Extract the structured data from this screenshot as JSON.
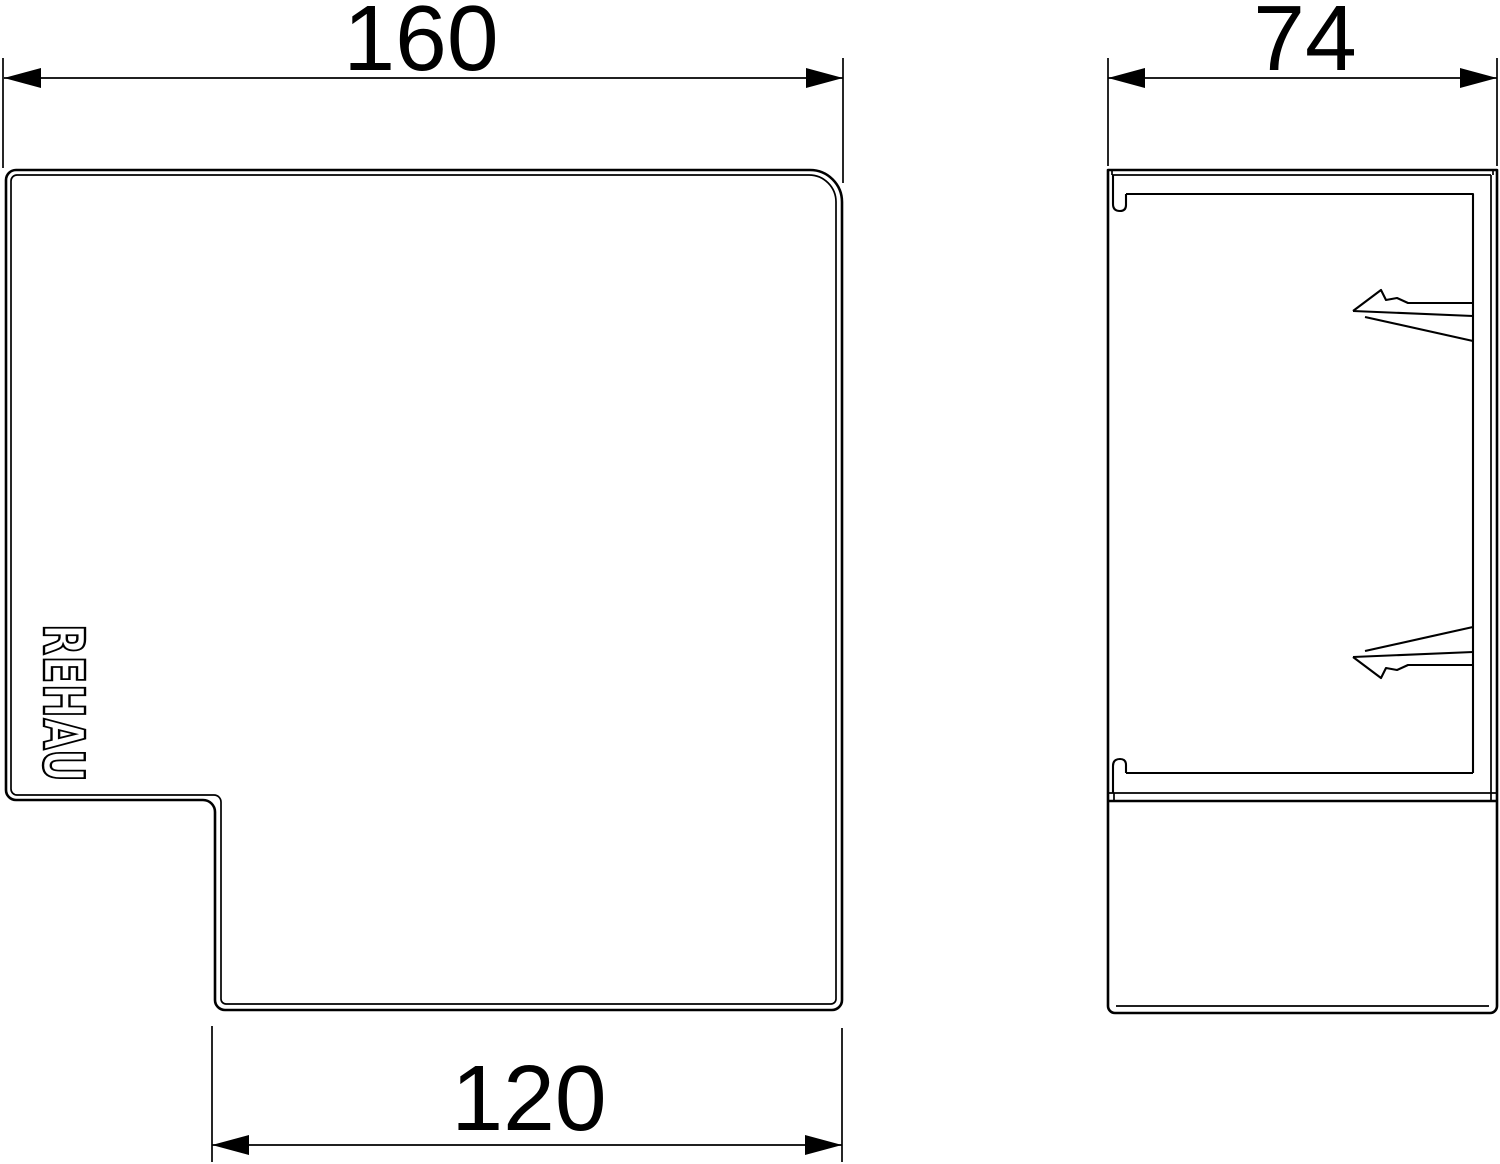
{
  "drawing": {
    "logo_text": "REHAU",
    "colors": {
      "line": "#000000",
      "background": "#ffffff"
    },
    "views": {
      "front": {
        "name": "front-view"
      },
      "side": {
        "name": "side-view"
      }
    },
    "dimensions": {
      "front_overall_width": {
        "label": "160"
      },
      "side_depth": {
        "label": "74"
      },
      "front_lower_width": {
        "label": "120"
      }
    }
  }
}
